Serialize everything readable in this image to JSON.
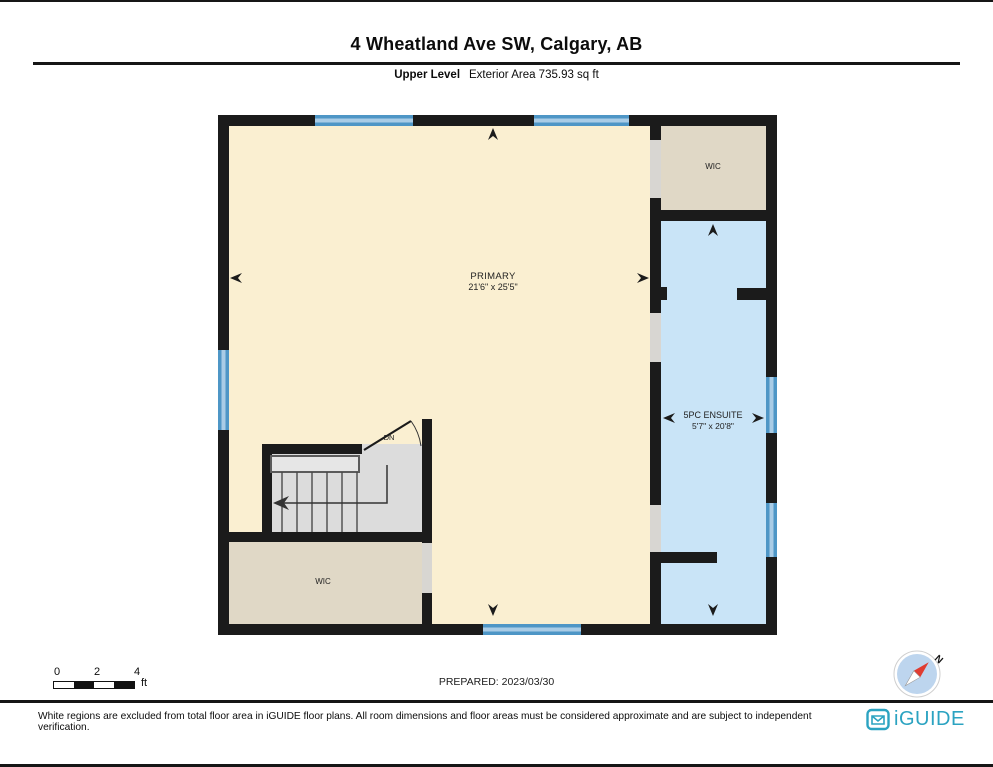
{
  "page": {
    "title": "4 Wheatland Ave SW, Calgary, AB",
    "level_label": "Upper Level",
    "area_label": "Exterior Area 735.93 sq ft",
    "prepared_label": "PREPARED: 2023/03/30",
    "disclaimer": "White regions are excluded from total floor area in iGUIDE floor plans. All room dimensions and floor areas must be considered approximate and are subject to independent verification.",
    "brand": "iGUIDE"
  },
  "rooms": {
    "primary": {
      "name": "PRIMARY",
      "dims": "21'6\" x 25'5\""
    },
    "wic_upper": {
      "name": "WIC"
    },
    "ensuite": {
      "name": "5PC ENSUITE",
      "dims": "5'7\" x 20'8\""
    },
    "wic_lower": {
      "name": "WIC"
    }
  },
  "stairs": {
    "direction_label": "DN"
  },
  "compass": {
    "north_label": "N"
  },
  "scale_bar": {
    "ticks": [
      "0",
      "2",
      "4"
    ],
    "unit": "ft"
  },
  "colors": {
    "wall": "#1b1b1b",
    "primary_fill": "#FAEFD1",
    "wic_fill": "#E0D8C6",
    "ensuite_fill": "#C9E4F7",
    "window_frame": "#4E96C6",
    "window_glass": "#A9CCE6",
    "stair_gray": "#DCDCDC",
    "door_gap": "#D8D6D2",
    "brand_teal": "#2BA3C1",
    "compass_red": "#E03C31",
    "compass_blue": "#BDD5EE"
  }
}
